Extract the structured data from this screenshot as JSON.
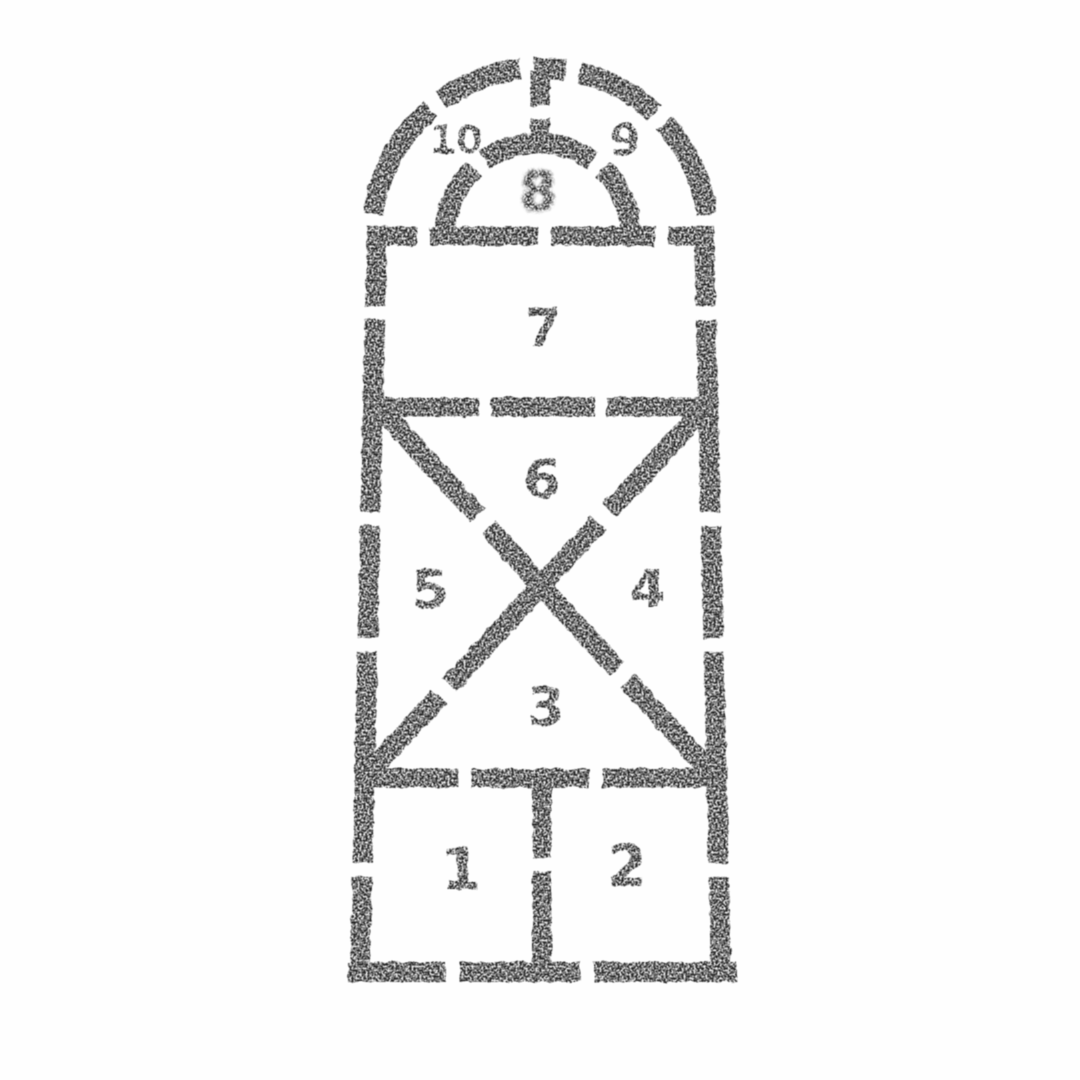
{
  "colors": {
    "ink": "#1f1f1f",
    "background": "#fefefe"
  },
  "court": {
    "cells": [
      {
        "label": "1"
      },
      {
        "label": "2"
      },
      {
        "label": "3"
      },
      {
        "label": "4"
      },
      {
        "label": "5"
      },
      {
        "label": "6"
      },
      {
        "label": "7"
      },
      {
        "label": "8"
      },
      {
        "label": "9"
      },
      {
        "label": "10"
      }
    ]
  }
}
